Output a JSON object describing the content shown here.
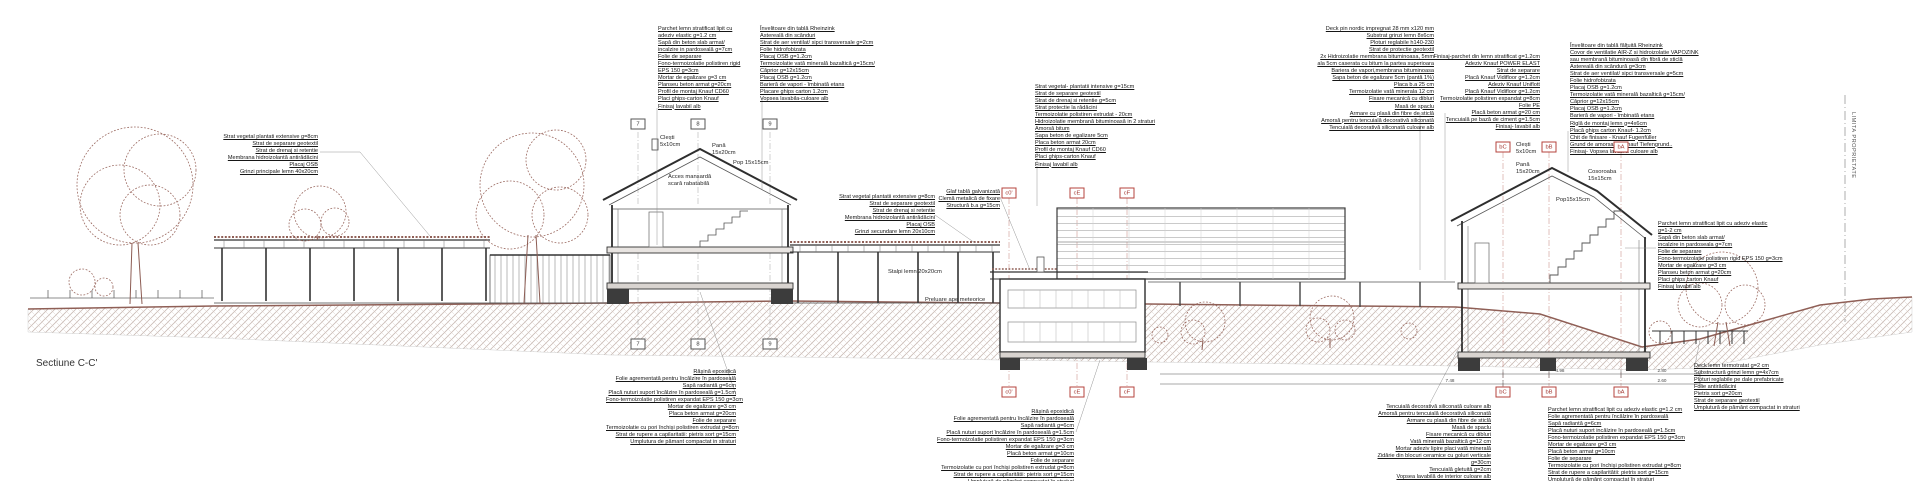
{
  "title": "Sectiune C-C'",
  "property_line_label": "LIMITA PROPRIETATE",
  "colors": {
    "terrain_line": "#8f5f56",
    "vegetation": "#9b6a61",
    "hatch": "#c6b8b2",
    "drawing_line": "#333333",
    "marker_red": "#a33832"
  },
  "annotations": {
    "roof_garden_left": {
      "lines": [
        "Strat vegetal plantati extensive g=8cm",
        "Strat de separare geotextil",
        "Strat de drenaj si retentie",
        "Membrana hidroizolantă antirădăcini",
        "Placaj OSB",
        "Grinzi principale lemn 40x20cm"
      ]
    },
    "house1_floor": {
      "lines": [
        "Parchet lemn stratificat lipit cu",
        "adeziv elastic g=1.2 cm",
        "Sapă din beton slab armat/",
        "incalzire in pardoseală g=7cm",
        "Folie de separare",
        "Fono-termoizolatie polistiren rigid",
        "EPS 150 g=3cm",
        "Mortar de egalizare g=3 cm",
        "Planseu beton armat g=20cm",
        "Profil de montaj Knauf CD60",
        "Placi ghips-carton Knauf",
        "Finisaj lavabil alb"
      ]
    },
    "house1_roof": {
      "lines": [
        "Învelitoare din tablă Rheinzink",
        "Astereală din scânduri",
        "Strat de aer ventilat/ sipci transversale g=2cm",
        "Folie hidrofobizata",
        "Placaj OSB g=1.2cm",
        "Termoizolatie vată minerală bazaltică g=15cm/",
        "Căprior g=12x15cm",
        "Placaj OSB g=1.2cm",
        "Barieră de vapori - îmbinată etans",
        "Placare ghips carton 1.2cm",
        "Vopsea lavabila-culoare alb"
      ]
    },
    "canopy_roof": {
      "lines": [
        "Strat vegetal plantatii extensive g=8cm",
        "Strat de separare geotextil",
        "Strat de drenaj si retentie",
        "Membrana hidroizolantă antirădăcini",
        "Placaj OSB",
        "Grinzi secundare lemn 20x10cm"
      ]
    },
    "glaf": {
      "lines": [
        "Glaf tablă galvanizată",
        "Clemă metalică de fixare",
        "Structură b.a g=15cm"
      ]
    },
    "intensive_roof": {
      "lines": [
        "Strat vegetal- plantatii intensive g=15cm",
        "Strat de separare geotextil",
        "Strat de drenaj si retentie g=5cm",
        "Strat protectie la rădăcini",
        "Termoizolatie polistiren extrudat - 20cm",
        "Hidroizolatie membrană bituminoasă in 2 straturi",
        "Amorsă bitum",
        "Sapa beton de egalizare 5cm",
        "Placa beton armat 20cm",
        "Profil de montaj Knauf CD60",
        "Placi ghips-carton Knauf",
        "Finisaj lavabil alb"
      ]
    },
    "terrace_layers": {
      "lines": [
        "Deck pin nordic impregnat 28 mm x120 mm",
        "Substrat grinzi lemn 8x6cm",
        "Ploturi reglabile h140-230",
        "Strat de protectie geotextil",
        "2x Hidroizolatie membrana bituminoasa, 5mm",
        "ala 5cm caserata cu bitum la partea superioara",
        "Bariera de vapori,membrana bituminoasa",
        "Sapa beton de egalizare 5cm (pantă 1%)",
        "Placa b.a 25 cm",
        "Termoizolatie vată minerala 12 cm",
        "Fixare mecanică cu dibluri",
        "Masă de spaclu",
        "Armare cu plasă din fibre de sticlă",
        "Amorsă pentru tencuială decorativă siliconată",
        "Tencuială decorativă siliconată culoare alb"
      ]
    },
    "floating_floor": {
      "lines": [
        "Finisaj-parchet din lemn stratificat g=1.2cm",
        "Adeziv Knauf POWER ELAST",
        "Strat de separare",
        "Placă Knauf Vidifloor g=1.2cm",
        "Adeziv Knauf Uniflott",
        "Placă Knauf Vidifloor g=1.2cm",
        "Termoizolatie polistiren expandat g=8cm",
        "Folie PE",
        "Placă beton armat g=20 cm",
        "Tencuială pe bază de ciment g=1.5cm",
        "Finisaj- lavabil alb"
      ]
    },
    "house3_roof": {
      "lines": [
        "Învelitoare din tablă fălțuită Rheinzink",
        "Covor de ventilatie AIR-Z si hidroizolatie VAPOZINK",
        "sau membrană bituminoasă din fibră de sticlă",
        "Astereală din scândură g=3cm",
        "Strat de aer ventilat/ sipci transversale g=5cm",
        "Folie hidrofobizata",
        "Placaj OSB g=1.2cm",
        "Termoizolatie vată minerală bazaltică g=15cm/",
        "Căprior g=12x15cm",
        "Placaj OSB g=1.2cm",
        "Barieră de vapori - îmbinată etans",
        "Riglă de montaj lemn g=4x6cm",
        "Placă ghips carton Knauf- 1.2cm",
        "Chit de finisare - Knauf Fugenfüller",
        "Grund de amorsare - Knauf Tiefengrund..",
        "Finisaj- Vopsea lavabilă culoare alb"
      ]
    },
    "house3_floor": {
      "lines": [
        "Parchet lemn stratificat lipit cu adeziv elastic",
        "g=1-2 cm",
        "Sapă din beton slab armat/",
        "incalzire in pardoseala g=7cm",
        "Folie de separare",
        "Fono-termoizolatie polistiren rigid EPS 150 g=3cm",
        "Mortar de egalizare g=3 cm",
        "Planseu beton armat g=20cm",
        "Placi ghips carton Knauf",
        "Finisaj lavabil alb"
      ]
    },
    "slab_grade_1": {
      "lines": [
        "Rășină epoxidică",
        "Folie agrementată pentru încălzire în pardoseală",
        "Sapă radiantă g=6cm",
        "Placă nuturi suport încălzire în pardoseală g=1.5cm",
        "Fono-termoizolatie polistiren expandat EPS 150 g=3cm",
        "Mortar de egalizare g=3 cm",
        "Placa beton armat g=20cm",
        "Folie de separare",
        "Termoizolatie cu pori închiși polistiren extrudat g=8cm",
        "Strat de rupere a capilaritatii: pietris sort g=15cm",
        "Umplutura de pămant compactat in straturi"
      ]
    },
    "slab_grade_2": {
      "lines": [
        "Rășină epoxidică",
        "Folie agrementată pentru încălzire în pardoseală",
        "Sapă radiantă g=6cm",
        "Placă nuturi suport încălzire în pardoseală g=1.5cm",
        "Fono-termoizolatie polistiren expandat EPS 150 g=3cm",
        "Mortar de egalizare g=3 cm",
        "Placă beton armat g=10cm",
        "Folie de separare",
        "Termoizolatie cu pori închiși polistiren extrudat g=8cm",
        "Strat de rupere a capilaritătii: pietris sort g=15cm",
        "Umplutură de pământ compactat în straturi"
      ]
    },
    "wall_layers": {
      "lines": [
        "Tencuială decorativă siliconată culoare alb",
        "Amorsă pentru tencuială decorativă siliconată",
        "Armare cu plasă din fibre de sticlă",
        "Masă de spaclu",
        "Fixare mecanică cu dibluri",
        "Vată minerală bazaltică  g=12 cm",
        "Mortar adeziv lipire placi vată minerală",
        "Zidărie din blocuri ceramice cu goluri verticale",
        "g=30cm",
        "Tencuială gletuită g=2cm",
        "Vopsea lavabilă de interior culoare alb"
      ]
    },
    "slab_grade_3": {
      "lines": [
        "Parchet lemn stratificat lipit cu adeziv elastic g=1.2 cm",
        "Folie agrementată pentru încălzire în pardoseală",
        "Sapă radiantă g=6cm",
        "Placă nuturi suport incălzire în pardoseală g=1.5cm",
        "Fono-termoizolatie polistiren expandat EPS 150 g=3cm",
        "Mortar de egalizare g=3 cm",
        "Placă beton armat g=10cm",
        "Folie de separare",
        "Termoizolatie cu pori închiși polistiren extrudat g=8cm",
        "Strat de rupere a capilaritătii: pietris sort g=15cm",
        "Umplutură de pământ compactat în straturi"
      ]
    },
    "deck_layers": {
      "lines": [
        "Deck lemn termotratat g=2 cm",
        "Substructură grinzi lemn g=4x7cm",
        "Ploturi reglabile pe dale prefabricate",
        "Folie antirădăcini",
        "Pietris sort g=20cm",
        "Strat de separare geotextil",
        "Umplutură de pământ compactat in straturi"
      ]
    }
  },
  "labels": {
    "clesti1": "Clești\n5x10cm",
    "pana1": "Pană\n15x20cm",
    "pop1": "Pop 15x15cm",
    "acces": "Acces mansardă\nscară rabatabilă",
    "stalpi": "Stalpi lemn 20x20cm",
    "preluare": "Preluare ape meteorice",
    "clesti3": "Clești\n5x10cm",
    "pana3": "Pană\n15x20cm",
    "cosoroaba": "Cosoroaba\n15x15cm",
    "pop3": "Pop15x15cm"
  },
  "markers": {
    "house1": [
      "7",
      "8",
      "9"
    ],
    "bldg2": [
      "c0'",
      "cE",
      "cF"
    ],
    "bldg3": [
      "bC",
      "bB",
      "bA"
    ]
  },
  "dims": {
    "row1": [
      "4.98",
      "2.80"
    ],
    "row2": [
      "7.48",
      "2.60"
    ]
  }
}
